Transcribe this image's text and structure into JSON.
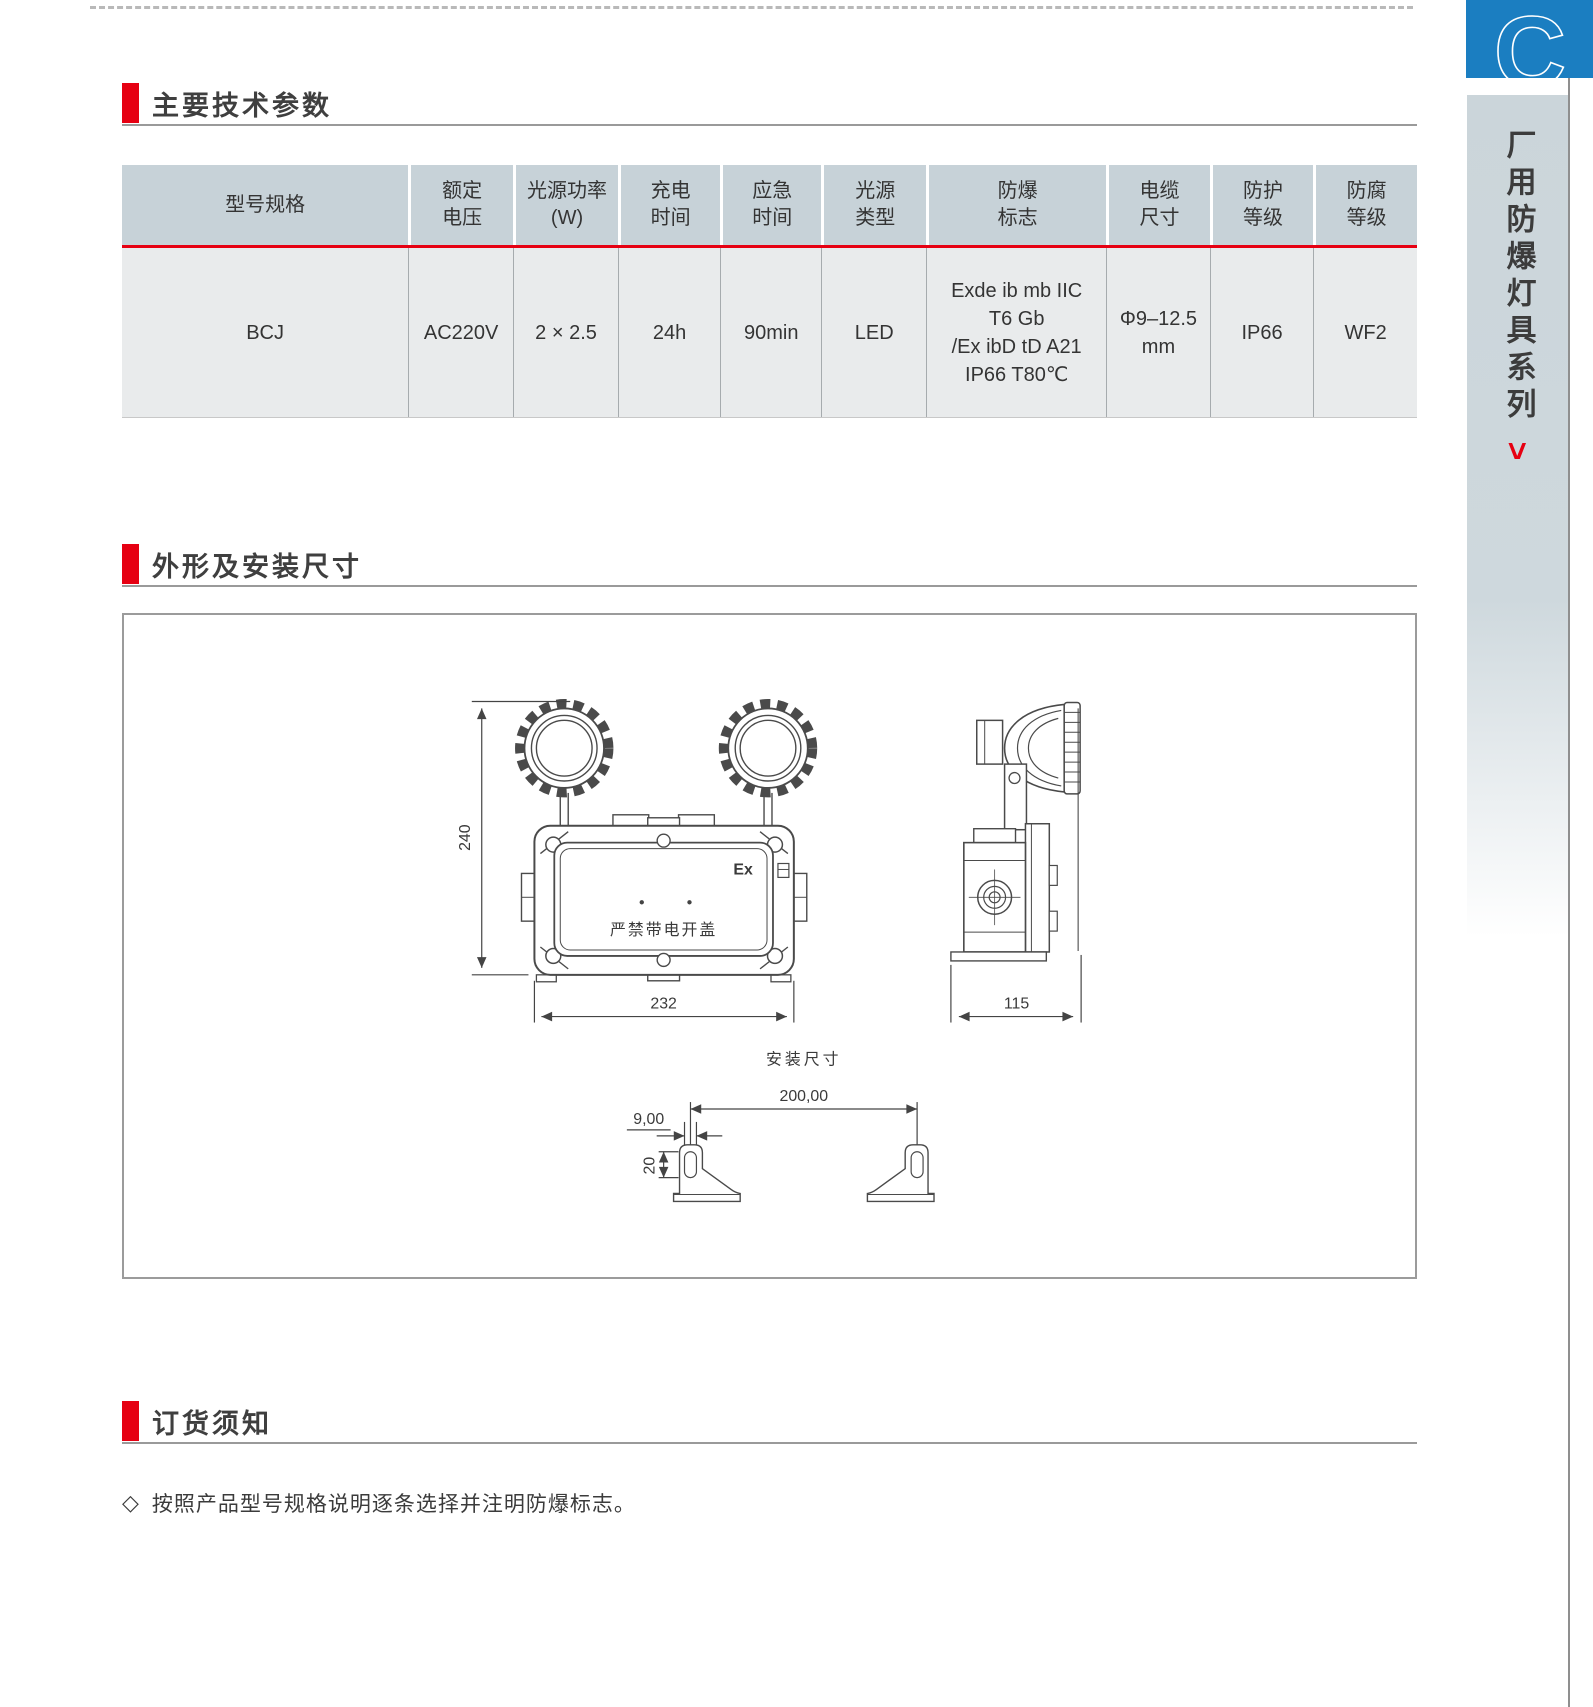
{
  "sections": {
    "params": {
      "title": "主要技术参数"
    },
    "outline": {
      "title": "外形及安装尺寸"
    },
    "ordering": {
      "title": "订货须知"
    }
  },
  "table": {
    "headers": [
      [
        "型号规格"
      ],
      [
        "额定",
        "电压"
      ],
      [
        "光源功率",
        "(W)"
      ],
      [
        "充电",
        "时间"
      ],
      [
        "应急",
        "时间"
      ],
      [
        "光源",
        "类型"
      ],
      [
        "防爆",
        "标志"
      ],
      [
        "电缆",
        "尺寸"
      ],
      [
        "防护",
        "等级"
      ],
      [
        "防腐",
        "等级"
      ]
    ],
    "row": {
      "model": "BCJ",
      "voltage": "AC220V",
      "power": "2 × 2.5",
      "charge_time": "24h",
      "emergency_time": "90min",
      "source_type": "LED",
      "ex_mark": [
        "Exde ib mb IIC",
        "T6 Gb",
        "/Ex ibD tD A21",
        "IP66 T80℃"
      ],
      "cable_size": [
        "Φ9–12.5",
        "mm"
      ],
      "ip_rating": "IP66",
      "anticorrosion": "WF2"
    }
  },
  "drawing": {
    "front_height": "240",
    "front_width": "232",
    "side_depth": "115",
    "ex_label": "Ex",
    "warning_label": "严禁带电开盖",
    "install_title": "安装尺寸",
    "hole_spacing": "200,00",
    "slot_width": "9,00",
    "slot_height": "20"
  },
  "ordering_note": {
    "bullet": "◇",
    "text": "按照产品型号规格说明逐条选择并注明防爆标志。"
  },
  "sidebar": {
    "chapter_letter": "C",
    "series_title": "厂用防爆灯具系列",
    "arrow": ">"
  },
  "colors": {
    "accent_red": "#e60012",
    "chapter_blue": "#1b7ec1",
    "table_header_bg": "#c7d2d8",
    "table_body_bg": "#e9ebec"
  }
}
